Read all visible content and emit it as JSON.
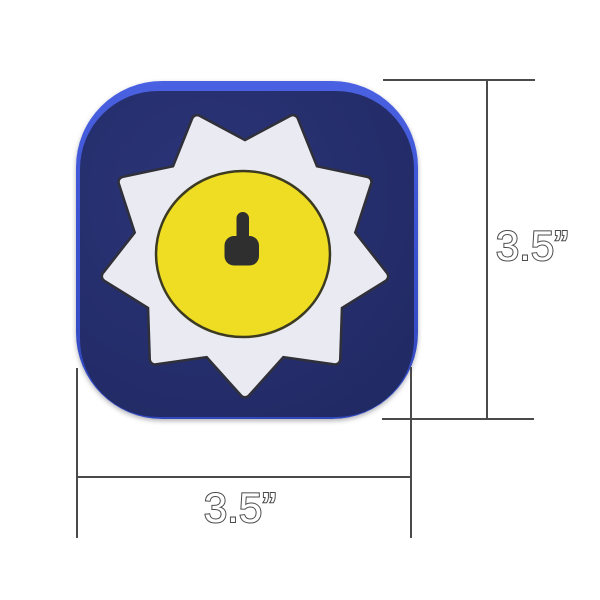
{
  "labels": {
    "height": "3.5”",
    "width": "3.5”"
  },
  "icon": {
    "name": "sun-badge-app-icon",
    "glyph": "key-icon",
    "colors": {
      "rim": "#3e55d4",
      "body": "#252e6c",
      "badge": "#e9eaf2",
      "badge_outline": "#30303a",
      "circle": "#eedd22",
      "circle_outline": "#3c3a20",
      "glyph": "#2f2f2f"
    }
  },
  "annotation": {
    "line_color": "#4a4a4a",
    "measured_width_inches": "3.5",
    "measured_height_inches": "3.5"
  }
}
